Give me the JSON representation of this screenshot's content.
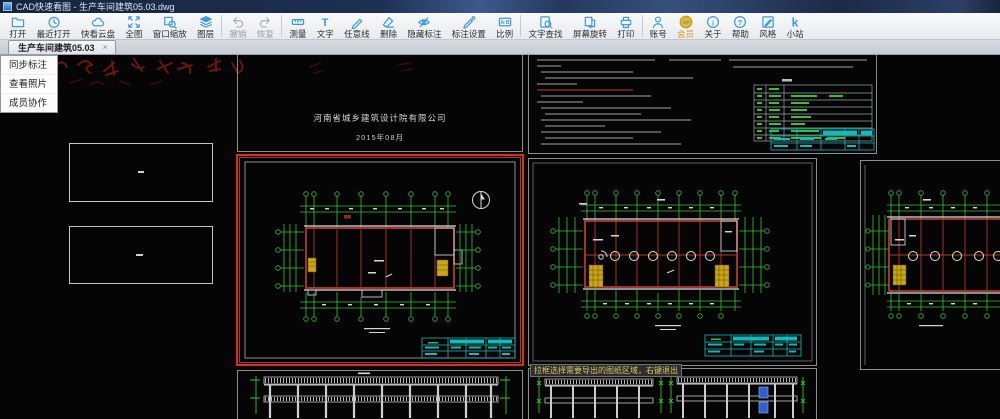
{
  "window": {
    "title": "CAD快速看图 - 生产车间建筑05.03.dwg"
  },
  "toolbar": {
    "items": [
      {
        "label": "打开"
      },
      {
        "label": "最近打开"
      },
      {
        "label": "快看云盘"
      },
      {
        "label": "全图"
      },
      {
        "label": "窗口缩放"
      },
      {
        "label": "图层"
      },
      {
        "label": "撤销",
        "disabled": true
      },
      {
        "label": "恢复",
        "disabled": true
      },
      {
        "label": "测量"
      },
      {
        "label": "文字",
        "glyph": "T"
      },
      {
        "label": "任意线"
      },
      {
        "label": "删除"
      },
      {
        "label": "隐藏标注"
      },
      {
        "label": "标注设置"
      },
      {
        "label": "比例",
        "glyph": "A:B"
      },
      {
        "label": "文字查找"
      },
      {
        "label": "屏幕旋转"
      },
      {
        "label": "打印"
      },
      {
        "label": "账号"
      },
      {
        "label": "会员",
        "glyph": "VIP"
      },
      {
        "label": "关于",
        "glyph": "i"
      },
      {
        "label": "帮助",
        "glyph": "?"
      },
      {
        "label": "风格"
      },
      {
        "label": "小站",
        "glyph": "k"
      }
    ]
  },
  "tab": {
    "label": "生产车间建筑05.03",
    "close": "×"
  },
  "side_menu": {
    "items": [
      "同步标注",
      "查看照片",
      "成员协作"
    ]
  },
  "canvas": {
    "cover_sheet": {
      "company": "河南省城乡建筑设计院有限公司",
      "date": "2015年08月"
    },
    "tooltip": "拉框选择需要导出的图纸区域，右键退出",
    "colors": {
      "toolbar_accent": "#3f9bd7",
      "vip_gold": "#e6b830",
      "selection_red": "#d43025",
      "axis_dim_green": "#35c035",
      "wall_grid_red": "#b3372e",
      "titleblock_cyan": "#17b8b8",
      "stair_yellow": "#c9a616",
      "window_blue": "#2e5fd4",
      "canvas_background": "#050505"
    }
  }
}
